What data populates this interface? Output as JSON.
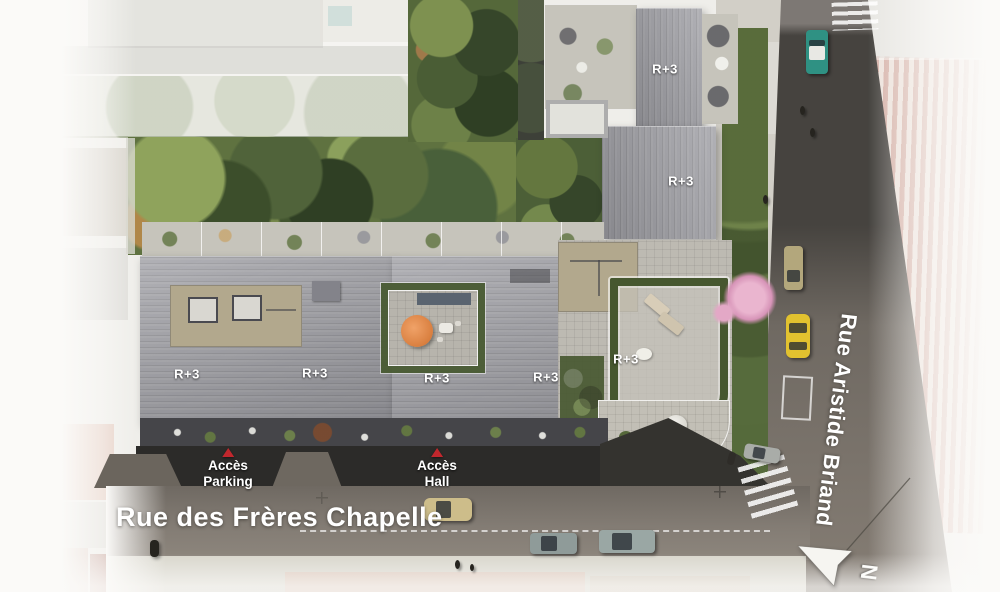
{
  "streets": {
    "bottom": {
      "name": "Rue des Frères Chapelle"
    },
    "right": {
      "name": "Rue Aristide Briand"
    }
  },
  "access_labels": {
    "parking": {
      "line1": "Accès",
      "line2": "Parking"
    },
    "hall": {
      "line1": "Accès",
      "line2": "Hall"
    }
  },
  "roof_labels": [
    {
      "text": "R+3"
    },
    {
      "text": "R+3"
    },
    {
      "text": "R+3"
    },
    {
      "text": "R+3"
    },
    {
      "text": "R+3"
    },
    {
      "text": "R+3"
    },
    {
      "text": "R+3"
    }
  ],
  "compass": {
    "north_letter": "N"
  },
  "colors": {
    "label_white": "#ffffff",
    "access_arrow_red": "#c1272d",
    "roof_gray": "#9d9da3",
    "dark_facade": "#2c2b29",
    "street_asphalt": "#7d766f",
    "street_dark": "#46433f",
    "garden_green": "#5f7240",
    "hedge_green": "#46572f",
    "terrace_paver": "#c6c4bb",
    "umbrella_orange": "#d97f3f",
    "blossom_pink": "#e3a8c6",
    "taxi_yellow": "#e2c22f",
    "teal_car": "#2f9183",
    "gold_car": "#b3a77c",
    "beige_car": "#cdbd8a",
    "silver_car": "#9aa7a4"
  }
}
